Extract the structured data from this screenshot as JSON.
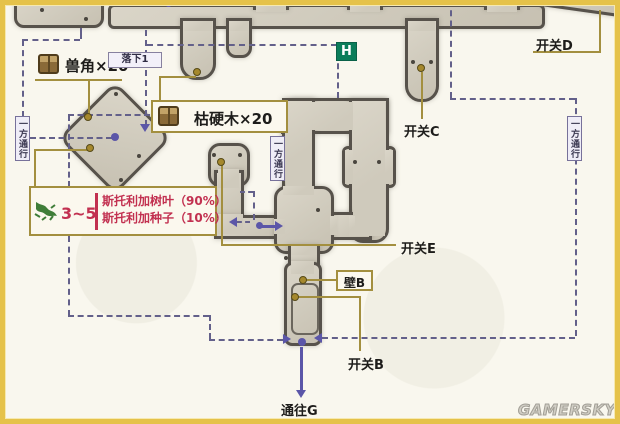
{
  "map_title_marker": "H",
  "watermark": "GAMERSKY",
  "item_labels": {
    "beast_horn": "兽角×20",
    "dry_hard_wood": "枯硬木×20"
  },
  "fall_label": "落下1",
  "one_way_label": "一方通行",
  "switch_labels": {
    "b": "开关B",
    "c": "开关C",
    "d": "开关D",
    "e": "开关E"
  },
  "wall_label": "壁B",
  "exit_label": "通往G",
  "enemy_info": {
    "count": "3~5",
    "drops": [
      "斯托利加树叶（90%）",
      "斯托利加种子（10%）"
    ]
  },
  "colors": {
    "frame": "#e5c24a",
    "stone": "#d3cec1",
    "stone_edge": "#57524b",
    "route_dash": "#63608a",
    "arrow_purple": "#5b56a8",
    "callout_gold": "#a38f3f",
    "enemy_red": "#c23050",
    "h_marker_green": "#0b7d5a"
  }
}
